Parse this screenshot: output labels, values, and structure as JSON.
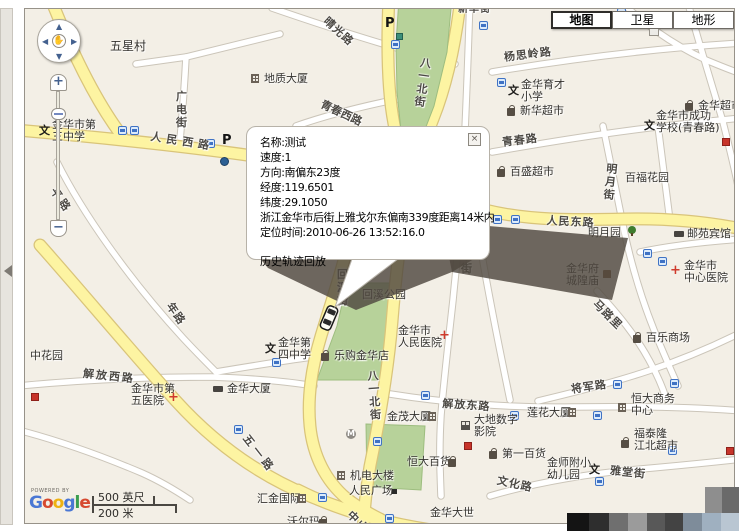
{
  "map_type_control": {
    "buttons": [
      {
        "label": "地图",
        "selected": true
      },
      {
        "label": "卫星",
        "selected": false
      },
      {
        "label": "地形",
        "selected": false
      }
    ]
  },
  "popup": {
    "lines": [
      "名称:测试",
      "速度:1",
      "方向:南偏东23度",
      "经度:119.6501",
      "纬度:29.1050",
      "浙江金华市后街上雅戈尔东偏南339度距离14米内",
      "定位时间:2010-06-26 13:52:16.0"
    ],
    "link_label": "历史轨迹回放",
    "close_glyph": "×"
  },
  "controls": {
    "zoom_in_glyph": "+",
    "zoom_out_glyph": "−",
    "pan_up_glyph": "▲",
    "pan_down_glyph": "▼",
    "pan_left_glyph": "◀",
    "pan_right_glyph": "▶",
    "pan_hand_glyph": "✋"
  },
  "attribution": {
    "powered_by": "POWERED BY",
    "logo_letters": [
      {
        "ch": "G",
        "color": "#4a77d4"
      },
      {
        "ch": "o",
        "color": "#d6492f"
      },
      {
        "ch": "o",
        "color": "#eeb211"
      },
      {
        "ch": "g",
        "color": "#4a77d4"
      },
      {
        "ch": "l",
        "color": "#3b9e4f"
      },
      {
        "ch": "e",
        "color": "#d6492f"
      }
    ]
  },
  "scale": {
    "feet_label": "500 英尺",
    "meter_label": "200 米"
  },
  "vehicle": {
    "name": "测试",
    "heading_deg": 203
  },
  "colors": {
    "land": "#f3efe6",
    "road_yellow": "#fdf4a2",
    "road_yellow_casing": "#d9c47a",
    "road_white": "#ffffff",
    "road_white_casing": "#cbc5b9",
    "park": "#b7d29a",
    "park_border": "#9dbd7f",
    "shadow": "rgba(79,72,64,0.82)"
  },
  "road_labels": [
    {
      "text": "人民西路",
      "x": 152,
      "y": 128,
      "rot": 9,
      "ls": 5
    },
    {
      "text": "人民东路",
      "x": 547,
      "y": 212,
      "rot": 3,
      "ls": 1
    },
    {
      "text": "解放西路",
      "x": 84,
      "y": 365,
      "rot": 6,
      "ls": 2
    },
    {
      "text": "解放东路",
      "x": 443,
      "y": 395,
      "rot": 4,
      "ls": 1
    },
    {
      "text": "青春路",
      "x": 501,
      "y": 134,
      "rot": -7,
      "ls": 1
    },
    {
      "text": "青春西路",
      "x": 325,
      "y": 96,
      "rot": 25,
      "ls": 0
    },
    {
      "text": "晴光路",
      "x": 331,
      "y": 13,
      "rot": 42,
      "ls": 1
    },
    {
      "text": "杨思岭路",
      "x": 503,
      "y": 49,
      "rot": -7,
      "ls": 1
    },
    {
      "text": "广电街",
      "x": 175,
      "y": 90,
      "vert": true
    },
    {
      "text": "回溪街",
      "x": 336,
      "y": 268,
      "vert": true
    },
    {
      "text": "八一北街",
      "x": 420,
      "y": 56,
      "vert": true,
      "rot": 8
    },
    {
      "text": "八一北街",
      "x": 366,
      "y": 370,
      "vert": true,
      "rot": -4
    },
    {
      "text": "明月街",
      "x": 606,
      "y": 162,
      "vert": true,
      "rot": 6
    },
    {
      "text": "华街",
      "x": 460,
      "y": 249,
      "vert": true
    },
    {
      "text": "新华街",
      "x": 458,
      "y": 0,
      "rot": 0,
      "ls": 1,
      "fs": 10
    },
    {
      "text": "五一路",
      "x": 252,
      "y": 431,
      "rot": 52,
      "ls": 4
    },
    {
      "text": "中山",
      "x": 355,
      "y": 507,
      "rot": 45,
      "ls": 2
    },
    {
      "text": "马路里",
      "x": 601,
      "y": 296,
      "rot": 45,
      "ls": 1
    },
    {
      "text": "将军路",
      "x": 570,
      "y": 381,
      "rot": -8,
      "ls": 1
    },
    {
      "text": "雅堂街",
      "x": 611,
      "y": 462,
      "rot": 6,
      "ls": 1
    },
    {
      "text": "文化路",
      "x": 499,
      "y": 472,
      "rot": 12,
      "ls": 1
    },
    {
      "text": "平路",
      "x": 60,
      "y": 184,
      "rot": 55,
      "ls": 3
    },
    {
      "text": "年路",
      "x": 176,
      "y": 299,
      "rot": 55,
      "ls": 1
    }
  ],
  "poi_labels": [
    {
      "lines": [
        "五星村"
      ],
      "x": 110,
      "y": 40,
      "fs": 12
    },
    {
      "lines": [
        "金华市第",
        "三中学"
      ],
      "x": 52,
      "y": 119,
      "icon": "school",
      "ix": 39,
      "iy": 126
    },
    {
      "lines": [
        "地质大厦"
      ],
      "x": 264,
      "y": 73,
      "icon": "building",
      "ix": 251,
      "iy": 74
    },
    {
      "lines": [
        "金华育才",
        "小学"
      ],
      "x": 521,
      "y": 79,
      "icon": "school",
      "ix": 508,
      "iy": 86
    },
    {
      "lines": [
        "新华超市"
      ],
      "x": 520,
      "y": 105,
      "icon": "shop",
      "ix": 507,
      "iy": 108
    },
    {
      "lines": [
        "金华超市"
      ],
      "x": 698,
      "y": 100,
      "icon": "shop",
      "ix": 685,
      "iy": 103
    },
    {
      "lines": [
        "金华市成功",
        "学校(青春路)"
      ],
      "x": 656,
      "y": 110,
      "icon": "school",
      "ix": 644,
      "iy": 121
    },
    {
      "lines": [
        "百盛超市"
      ],
      "x": 510,
      "y": 166,
      "icon": "shop",
      "ix": 497,
      "iy": 169
    },
    {
      "lines": [
        "百福花园"
      ],
      "x": 625,
      "y": 172
    },
    {
      "lines": [
        "邮苑宾馆"
      ],
      "x": 687,
      "y": 228,
      "icon": "hotel",
      "ix": 674,
      "iy": 228
    },
    {
      "lines": [
        "明月园"
      ],
      "x": 588,
      "y": 227,
      "icon": "tree",
      "ix": 628,
      "iy": 226
    },
    {
      "lines": [
        "金华府",
        "城隍庙"
      ],
      "x": 566,
      "y": 263,
      "icon": "temple",
      "ix": 603,
      "iy": 270
    },
    {
      "lines": [
        "金华市",
        "中心医院"
      ],
      "x": 684,
      "y": 260,
      "icon": "hospital",
      "ix": 670,
      "iy": 266
    },
    {
      "lines": [
        "回溪公园"
      ],
      "x": 362,
      "y": 289
    },
    {
      "lines": [
        "金华第",
        "四中学"
      ],
      "x": 278,
      "y": 337,
      "icon": "school",
      "ix": 265,
      "iy": 344
    },
    {
      "lines": [
        "乐购金华店"
      ],
      "x": 334,
      "y": 350,
      "icon": "shop",
      "ix": 321,
      "iy": 353
    },
    {
      "lines": [
        "金华市",
        "人民医院"
      ],
      "x": 398,
      "y": 325,
      "icon": "hospital",
      "ix": 439,
      "iy": 331
    },
    {
      "lines": [
        "中花园"
      ],
      "x": 30,
      "y": 350
    },
    {
      "lines": [
        "金华市第",
        "五医院"
      ],
      "x": 131,
      "y": 383,
      "icon": "hospital",
      "ix": 168,
      "iy": 393
    },
    {
      "lines": [
        "金华大厦"
      ],
      "x": 227,
      "y": 383,
      "icon": "hotel",
      "ix": 213,
      "iy": 383
    },
    {
      "lines": [
        "百乐商场"
      ],
      "x": 646,
      "y": 332,
      "icon": "shop",
      "ix": 633,
      "iy": 335
    },
    {
      "lines": [
        "恒大商务",
        "中心"
      ],
      "x": 631,
      "y": 393,
      "icon": "building",
      "ix": 618,
      "iy": 403
    },
    {
      "lines": [
        "莲花大厦"
      ],
      "x": 527,
      "y": 407,
      "icon": "building",
      "ix": 568,
      "iy": 408
    },
    {
      "lines": [
        "金茂大厦"
      ],
      "x": 387,
      "y": 411,
      "icon": "building",
      "ix": 428,
      "iy": 412
    },
    {
      "lines": [
        "大地数字",
        "影院"
      ],
      "x": 474,
      "y": 414,
      "icon": "cinema",
      "ix": 461,
      "iy": 421
    },
    {
      "lines": [
        "福泰隆",
        "江北超市"
      ],
      "x": 634,
      "y": 428,
      "icon": "shop",
      "ix": 621,
      "iy": 440
    },
    {
      "lines": [
        "恒大百货"
      ],
      "x": 407,
      "y": 456,
      "icon": "shop",
      "ix": 448,
      "iy": 459
    },
    {
      "lines": [
        "第一百货"
      ],
      "x": 502,
      "y": 448,
      "icon": "shop",
      "ix": 489,
      "iy": 451
    },
    {
      "lines": [
        "金师附小",
        "幼儿园"
      ],
      "x": 547,
      "y": 457,
      "icon": "school",
      "ix": 589,
      "iy": 465
    },
    {
      "lines": [
        "机电大楼"
      ],
      "x": 350,
      "y": 470,
      "icon": "building",
      "ix": 337,
      "iy": 471
    },
    {
      "lines": [
        "人民广场"
      ],
      "x": 349,
      "y": 485,
      "icon": "square",
      "ix": 392,
      "iy": 489
    },
    {
      "lines": [
        "汇金国际"
      ],
      "x": 257,
      "y": 493,
      "icon": "building",
      "ix": 298,
      "iy": 494
    },
    {
      "lines": [
        "沃尔玛"
      ],
      "x": 287,
      "y": 516,
      "icon": "shop",
      "ix": 319,
      "iy": 519
    },
    {
      "lines": [
        "金华大世"
      ],
      "x": 430,
      "y": 507
    }
  ],
  "point_icons": [
    {
      "type": "bus",
      "x": 118,
      "y": 126
    },
    {
      "type": "bus",
      "x": 130,
      "y": 126
    },
    {
      "type": "bus",
      "x": 206,
      "y": 139
    },
    {
      "type": "bus",
      "x": 497,
      "y": 78
    },
    {
      "type": "bus",
      "x": 391,
      "y": 40
    },
    {
      "type": "bus",
      "x": 479,
      "y": 21
    },
    {
      "type": "bus",
      "x": 617,
      "y": 8
    },
    {
      "type": "bus",
      "x": 643,
      "y": 12
    },
    {
      "type": "bus",
      "x": 493,
      "y": 215
    },
    {
      "type": "bus",
      "x": 511,
      "y": 215
    },
    {
      "type": "bus",
      "x": 643,
      "y": 249
    },
    {
      "type": "bus",
      "x": 658,
      "y": 257
    },
    {
      "type": "bus",
      "x": 613,
      "y": 380
    },
    {
      "type": "bus",
      "x": 670,
      "y": 379
    },
    {
      "type": "bus",
      "x": 421,
      "y": 391
    },
    {
      "type": "bus",
      "x": 373,
      "y": 437
    },
    {
      "type": "bus",
      "x": 318,
      "y": 493
    },
    {
      "type": "bus",
      "x": 385,
      "y": 514
    },
    {
      "type": "bus",
      "x": 510,
      "y": 411
    },
    {
      "type": "bus",
      "x": 593,
      "y": 411
    },
    {
      "type": "bus",
      "x": 668,
      "y": 446
    },
    {
      "type": "bus",
      "x": 595,
      "y": 477
    },
    {
      "type": "bus",
      "x": 234,
      "y": 425
    },
    {
      "type": "bus",
      "x": 272,
      "y": 358
    },
    {
      "type": "metro",
      "x": 346,
      "y": 429
    },
    {
      "type": "parking",
      "x": 222,
      "y": 135
    },
    {
      "type": "parking",
      "x": 385,
      "y": 18
    },
    {
      "type": "greenp",
      "x": 396,
      "y": 33
    },
    {
      "type": "bluedot",
      "x": 220,
      "y": 157
    },
    {
      "type": "red",
      "x": 31,
      "y": 393
    },
    {
      "type": "red",
      "x": 464,
      "y": 442
    },
    {
      "type": "red",
      "x": 722,
      "y": 138
    },
    {
      "type": "red",
      "x": 726,
      "y": 447
    }
  ],
  "icon_glyphs": {
    "school": "文",
    "hospital": "+",
    "parking": "P",
    "metro": "M"
  },
  "mosaic_blocks": [
    {
      "x": 567,
      "y": 513,
      "w": 22,
      "h": 18,
      "c": "#141414"
    },
    {
      "x": 589,
      "y": 513,
      "w": 20,
      "h": 18,
      "c": "#2e2e2e"
    },
    {
      "x": 609,
      "y": 513,
      "w": 19,
      "h": 18,
      "c": "#6f6f6f"
    },
    {
      "x": 628,
      "y": 513,
      "w": 19,
      "h": 18,
      "c": "#9b9b9b"
    },
    {
      "x": 647,
      "y": 513,
      "w": 18,
      "h": 18,
      "c": "#585858"
    },
    {
      "x": 665,
      "y": 513,
      "w": 18,
      "h": 18,
      "c": "#434343"
    },
    {
      "x": 683,
      "y": 513,
      "w": 19,
      "h": 18,
      "c": "#7e8c9a"
    },
    {
      "x": 702,
      "y": 513,
      "w": 19,
      "h": 18,
      "c": "#9fb0c0"
    },
    {
      "x": 721,
      "y": 513,
      "w": 18,
      "h": 18,
      "c": "#b9c6d2"
    },
    {
      "x": 705,
      "y": 487,
      "w": 17,
      "h": 26,
      "c": "#8e8e8e"
    },
    {
      "x": 722,
      "y": 487,
      "w": 17,
      "h": 26,
      "c": "#6a6a6a"
    }
  ]
}
